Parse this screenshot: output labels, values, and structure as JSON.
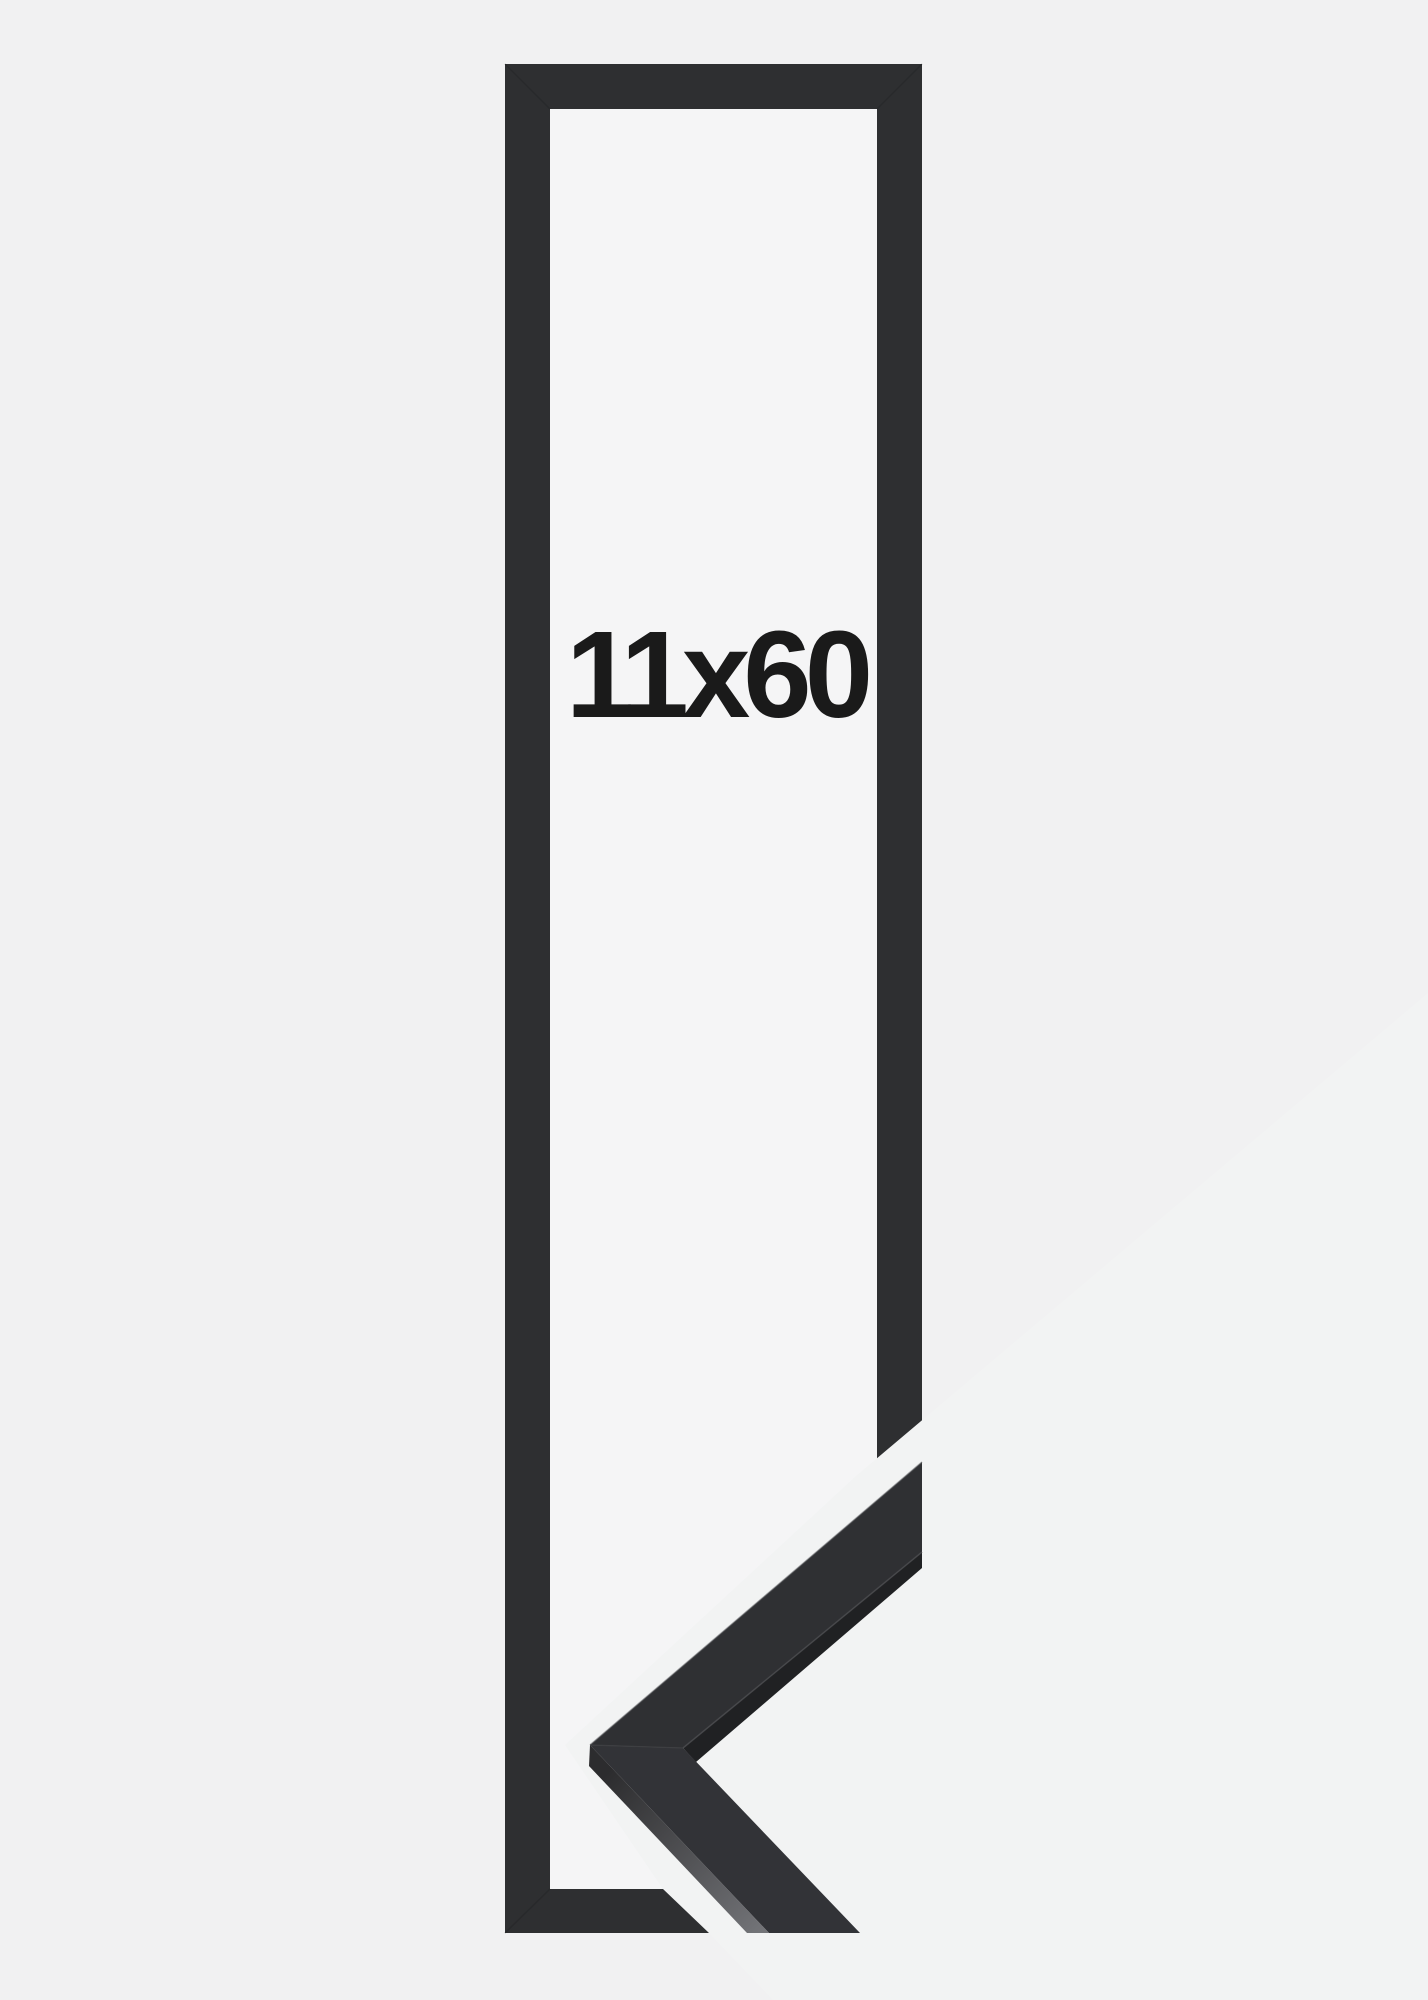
{
  "product_image": {
    "size_label": "11x60"
  },
  "colors": {
    "canvas_bg": "#f1f1f2",
    "paper": "#f5f5f6",
    "cutout_bg": "#f2f3f3",
    "frame": "#2e2f31",
    "frame_miter_line": "#1f1f21",
    "sample_face_upper": "#2f3033",
    "sample_face_lower": "#323337",
    "sample_inner_edge": "#202123",
    "sample_edge_seam": "#4b4c4f",
    "sample_top_highlight": "#595a5e",
    "sample_miter_seam": "#3f4043",
    "facet_dark": "#2c2c2e",
    "facet_light": "#737478",
    "label_color": "#1a1a1a"
  }
}
